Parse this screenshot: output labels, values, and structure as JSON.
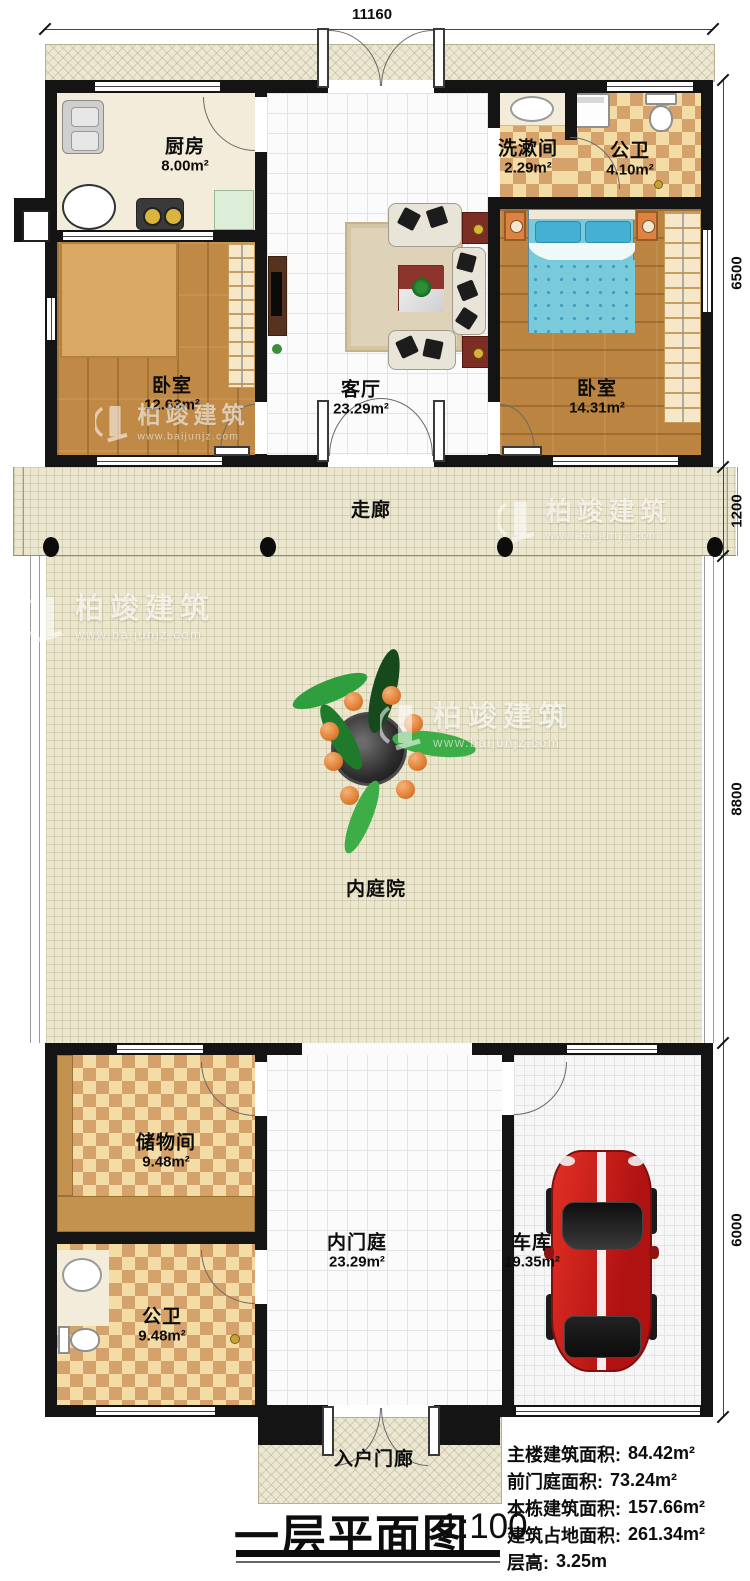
{
  "plan": {
    "dim_top": "11160",
    "dims_right": {
      "top_block": "6500",
      "corridor": "1200",
      "courtyard": "8800",
      "bottom_block": "6000"
    },
    "rooms": {
      "kitchen": {
        "name": "厨房",
        "area": "8.00m²"
      },
      "washroom": {
        "name": "洗漱间",
        "area": "2.29m²"
      },
      "bath_top": {
        "name": "公卫",
        "area": "4.10m²"
      },
      "bedroom_left": {
        "name": "卧室",
        "area": "12.63m²"
      },
      "living": {
        "name": "客厅",
        "area": "23.29m²"
      },
      "bedroom_right": {
        "name": "卧室",
        "area": "14.31m²"
      },
      "corridor": {
        "name": "走廊"
      },
      "courtyard": {
        "name": "内庭院"
      },
      "storage": {
        "name": "储物间",
        "area": "9.48m²"
      },
      "bath_bottom": {
        "name": "公卫",
        "area": "9.48m²"
      },
      "inner_court": {
        "name": "内门庭",
        "area": "23.29m²"
      },
      "garage": {
        "name": "车库",
        "area": "19.35m²"
      },
      "porch": {
        "name": "入户门廊"
      }
    },
    "title": {
      "text": "一层平面图",
      "scale": "1:100"
    },
    "stats": [
      {
        "label": "主楼建筑面积:",
        "value": "84.42m²"
      },
      {
        "label": "前门庭面积:",
        "value": "73.24m²"
      },
      {
        "label": "本栋建筑面积:",
        "value": "157.66m²"
      },
      {
        "label": "建筑占地面积:",
        "value": "261.34m²"
      },
      {
        "label": "层高:",
        "value": "3.25m"
      }
    ],
    "watermark": {
      "name": "柏竣建筑",
      "url": "www.baijunjz.com"
    },
    "colors": {
      "accent_car": "#c41d1d",
      "wall": "#141414",
      "bed_blue": "#79cbdb"
    }
  }
}
